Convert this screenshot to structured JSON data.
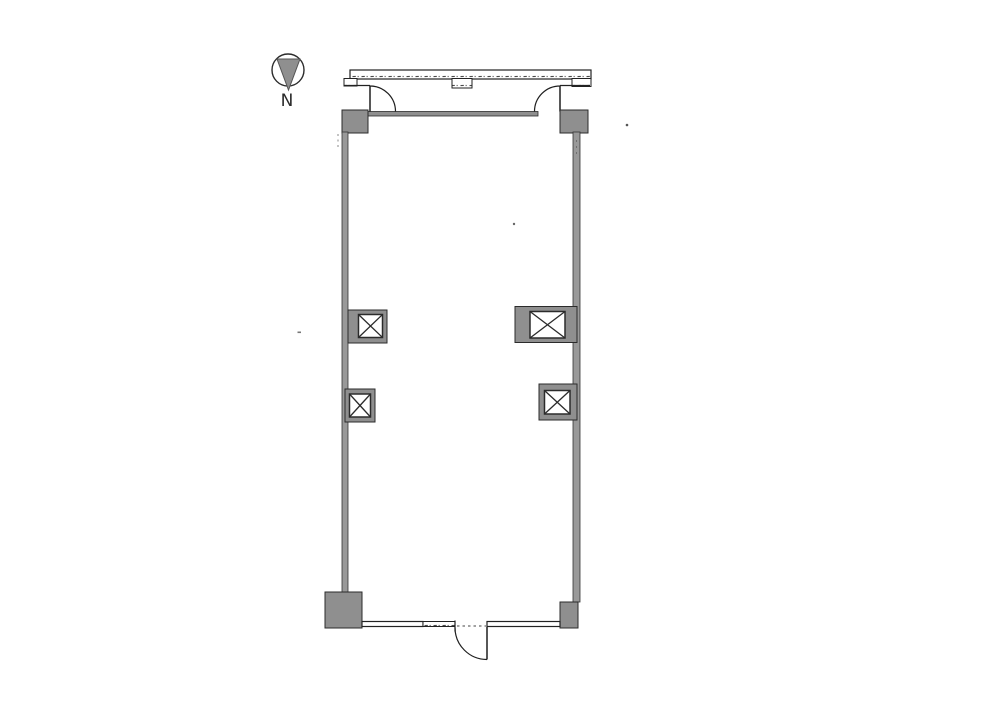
{
  "compass": {
    "label": "N"
  },
  "colors": {
    "background": "#ffffff",
    "line": "#2b2b2b",
    "wall_fill": "#999999",
    "column_fill": "#8f8f8f",
    "inner_wall_fill": "#8f8f8f",
    "compass_needle_fill": "#8f8f8f",
    "hatch_mark": "#4a4a4a"
  }
}
